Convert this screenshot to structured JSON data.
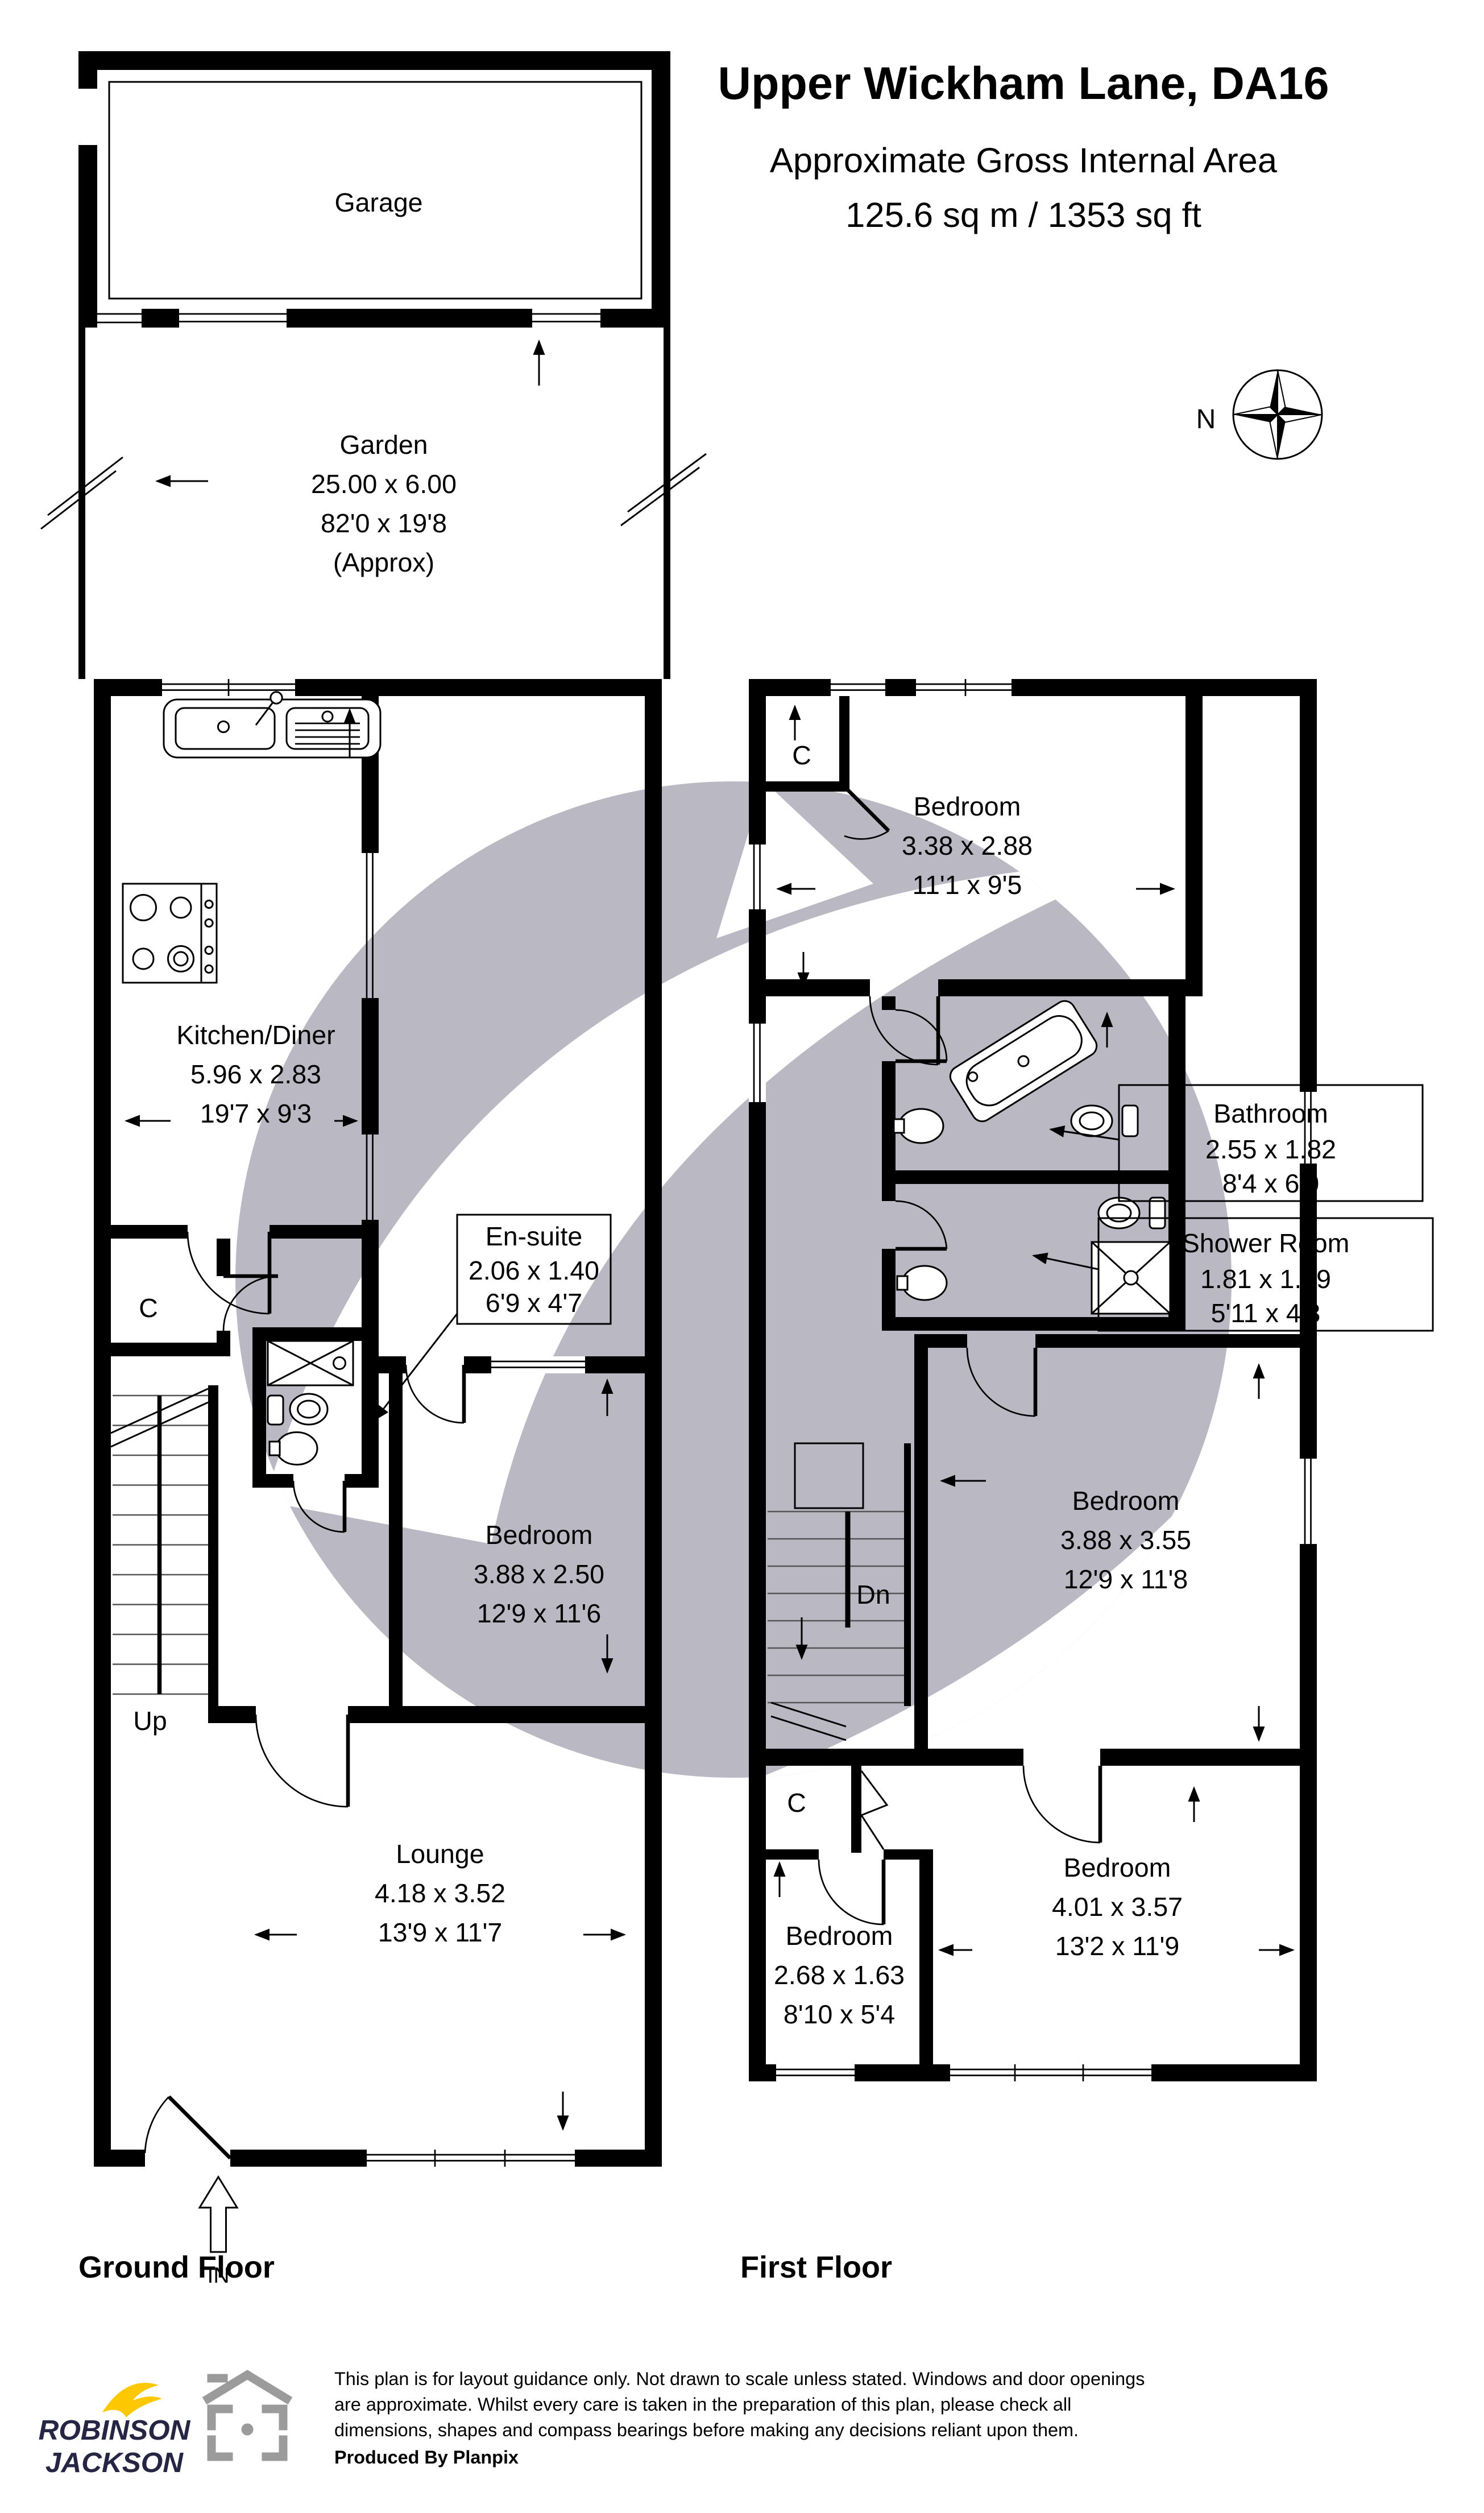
{
  "header": {
    "title": "Upper Wickham Lane, DA16",
    "area_line1": "Approximate Gross Internal Area",
    "area_line2": "125.6 sq m / 1353 sq ft"
  },
  "compass": {
    "north_label": "N"
  },
  "ground_floor": {
    "floor_label": "Ground Floor",
    "garage": {
      "name": "Garage"
    },
    "garden": {
      "name": "Garden",
      "metric": "25.00 x 6.00",
      "imperial": "82'0 x 19'8",
      "approx": "(Approx)"
    },
    "kitchen_diner": {
      "name": "Kitchen/Diner",
      "metric": "5.96 x 2.83",
      "imperial": "19'7 x 9'3"
    },
    "ensuite": {
      "name": "En-suite",
      "metric": "2.06 x 1.40",
      "imperial": "6'9 x 4'7"
    },
    "bedroom": {
      "name": "Bedroom",
      "metric": "3.88 x 2.50",
      "imperial": "12'9 x 11'6"
    },
    "lounge": {
      "name": "Lounge",
      "metric": "4.18 x 3.52",
      "imperial": "13'9 x 11'7"
    },
    "closet_label": "C",
    "up_label": "Up",
    "in_label": "IN"
  },
  "first_floor": {
    "floor_label": "First Floor",
    "bedroom_rear": {
      "name": "Bedroom",
      "metric": "3.38 x 2.88",
      "imperial": "11'1 x 9'5"
    },
    "bathroom": {
      "name": "Bathroom",
      "metric": "2.55 x 1.82",
      "imperial": "8'4 x 6'0"
    },
    "shower_room": {
      "name": "Shower Room",
      "metric": "1.81 x 1.29",
      "imperial": "5'11 x 4'3"
    },
    "bedroom_middle": {
      "name": "Bedroom",
      "metric": "3.88 x 3.55",
      "imperial": "12'9 x 11'8"
    },
    "bedroom_small": {
      "name": "Bedroom",
      "metric": "2.68 x 1.63",
      "imperial": "8'10 x 5'4"
    },
    "bedroom_front": {
      "name": "Bedroom",
      "metric": "4.01 x 3.57",
      "imperial": "13'2 x 11'9"
    },
    "closet_top_label": "C",
    "closet_bottom_label": "C",
    "dn_label": "Dn"
  },
  "footer": {
    "brand_line1": "ROBINSON",
    "brand_line2": "JACKSON",
    "disclaimer_line1": "This plan is for layout guidance only. Not drawn to scale unless stated. Windows and door openings",
    "disclaimer_line2": "are approximate. Whilst every care is taken in the preparation of this plan, please check all",
    "disclaimer_line3": "dimensions, shapes and compass bearings before making any decisions reliant upon them.",
    "produced_by": "Produced By Planpix"
  },
  "colors": {
    "wall": "#000000",
    "watermark": "#bab8c3",
    "brand_navy": "#262544",
    "brand_yellow": "#fdc800",
    "icon_gray": "#9b9b9b"
  }
}
